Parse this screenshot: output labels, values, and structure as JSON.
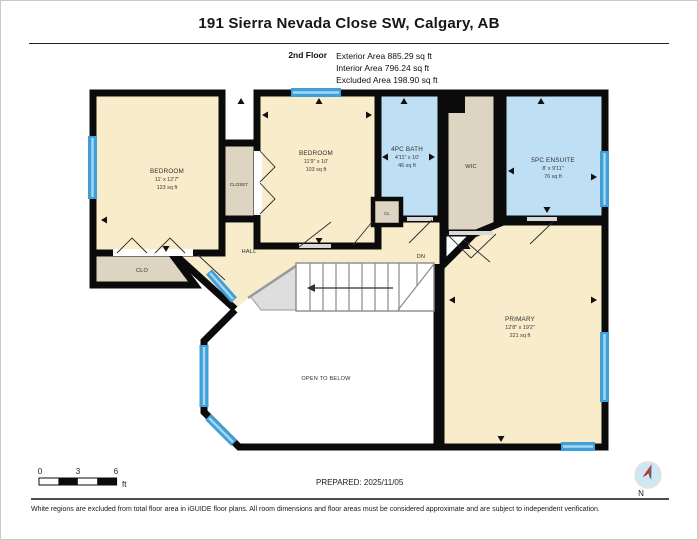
{
  "header": {
    "title": "191 Sierra Nevada Close SW, Calgary, AB",
    "floor_label": "2nd Floor",
    "stats": {
      "exterior": "Exterior Area 885.29 sq ft",
      "interior": "Interior Area 796.24 sq ft",
      "excluded": "Excluded Area 198.90 sq ft"
    }
  },
  "rooms": {
    "bedroom_left": {
      "name": "BEDROOM",
      "dims": "11' x 12'7\"",
      "area": "123 sq ft"
    },
    "bedroom_mid": {
      "name": "BEDROOM",
      "dims": "11'9\" x 10'",
      "area": "103 sq ft"
    },
    "bath": {
      "name": "4PC BATH",
      "dims": "4'11\" x 10'",
      "area": "46 sq ft"
    },
    "ensuite": {
      "name": "5PC ENSUITE",
      "dims": "8' x 9'11\"",
      "area": "76 sq ft"
    },
    "primary": {
      "name": "PRIMARY",
      "dims": "12'8\" x 19'2\"",
      "area": "221 sq ft"
    },
    "wic": {
      "label": "WIC"
    },
    "closet": {
      "label": "CLOSET"
    },
    "clo": {
      "label": "CLO"
    },
    "cl": {
      "label": "CL"
    },
    "hall": {
      "label": "HALL"
    },
    "dn": {
      "label": "DN"
    },
    "open_below": {
      "label": "OPEN TO BELOW"
    }
  },
  "scale_bar": {
    "tick0": "0",
    "tick3": "3",
    "tick6": "6",
    "unit": "ft"
  },
  "footer": {
    "prepared": "PREPARED: 2025/11/05",
    "compass_label": "N",
    "disclaimer": "White regions are excluded from total floor area in iGUIDE floor plans. All room dimensions and floor areas must be considered approximate and are subject to independent verification."
  },
  "colors": {
    "cream": "#f8ecca",
    "tan": "#ddd5c2",
    "blue": "#bfdff5",
    "winblue": "#3f9fd8",
    "winlite": "#a9d7ef",
    "wall": "#0b0b0b"
  }
}
